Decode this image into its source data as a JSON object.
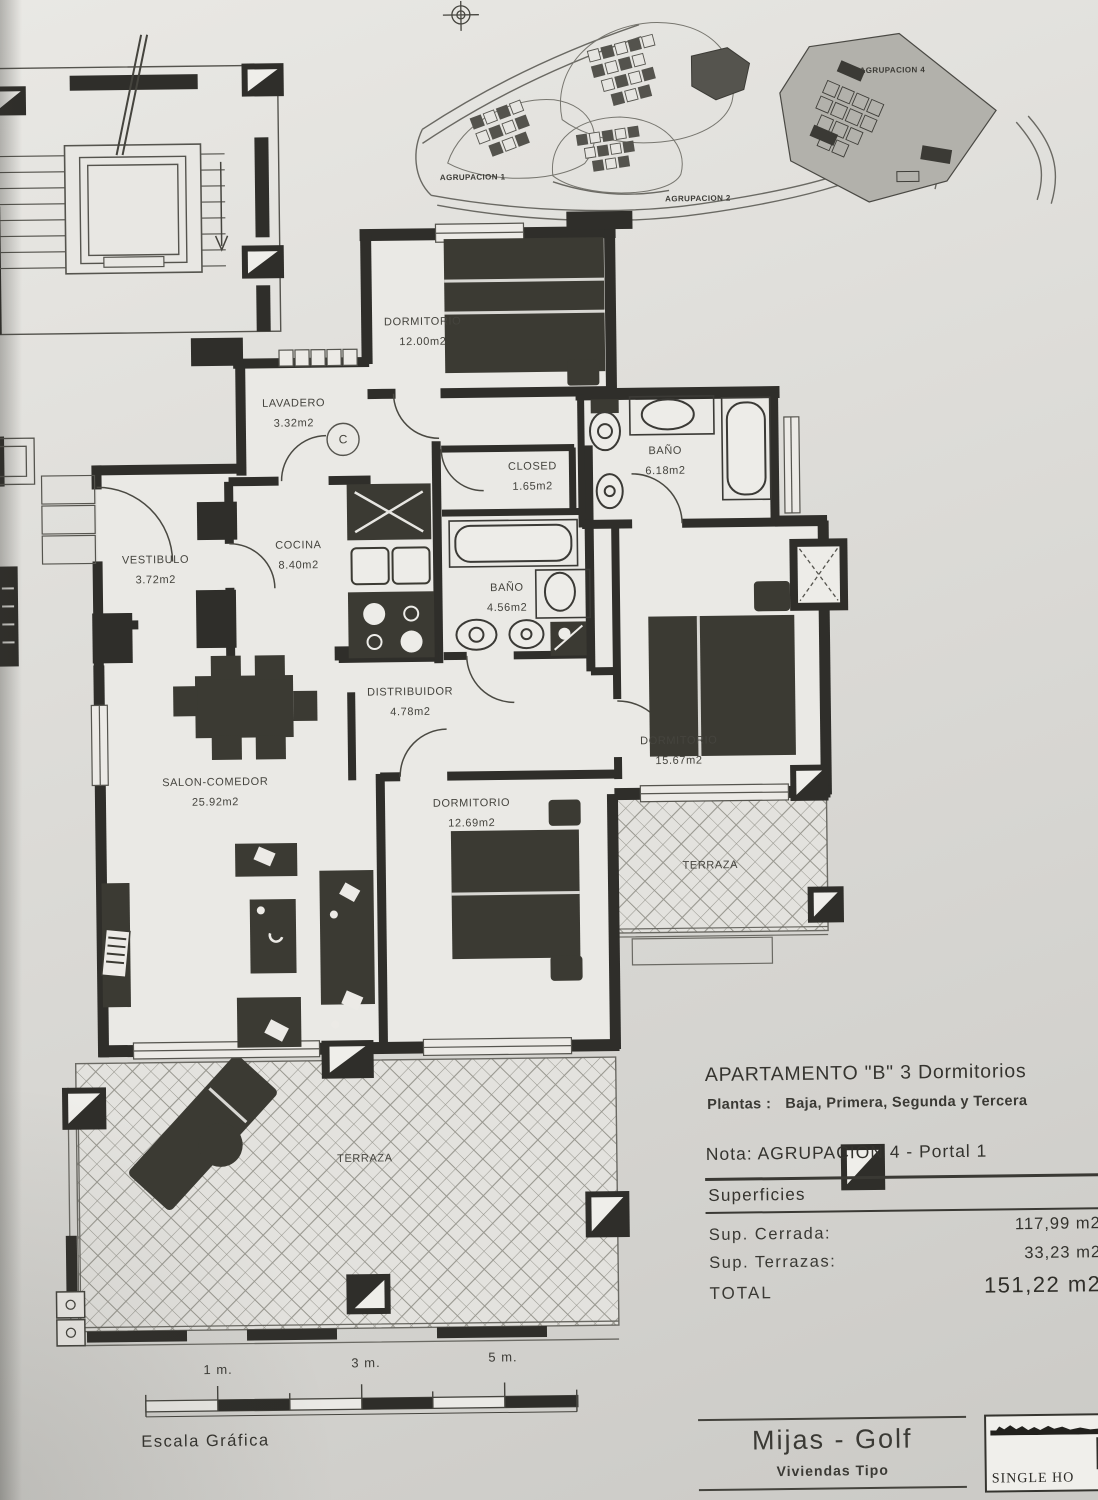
{
  "sheet": {
    "c_marker": "C"
  },
  "site_plan": {
    "labels": {
      "agrupacion1": "AGRUPACION 1",
      "agrupacion2": "AGRUPACION 2",
      "agrupacion4": "AGRUPACION 4"
    }
  },
  "plan": {
    "rooms": [
      {
        "name": "DORMITORIO",
        "area": "12.00m2"
      },
      {
        "name": "LAVADERO",
        "area": "3.32m2"
      },
      {
        "name": "CLOSED",
        "area": "1.65m2"
      },
      {
        "name": "BAÑO",
        "area": "6.18m2"
      },
      {
        "name": "VESTIBULO",
        "area": "3.72m2"
      },
      {
        "name": "COCINA",
        "area": "8.40m2"
      },
      {
        "name": "BAÑO",
        "area": "4.56m2"
      },
      {
        "name": "DISTRIBUIDOR",
        "area": "4.78m2"
      },
      {
        "name": "SALON-COMEDOR",
        "area": "25.92m2"
      },
      {
        "name": "DORMITORIO",
        "area": "12.69m2"
      },
      {
        "name": "DORMITORIO",
        "area": "15.67m2"
      },
      {
        "name": "TERRAZA"
      },
      {
        "name": "TERRAZA"
      }
    ]
  },
  "info": {
    "title": "APARTAMENTO \"B\" 3 Dormitorios",
    "plantas_label": "Plantas :",
    "plantas_value": "Baja, Primera, Segunda y Tercera",
    "nota": "Nota: AGRUPACION 4  - Portal 1",
    "superficies_heading": "Superficies",
    "sup_cerrada_label": "Sup. Cerrada:",
    "sup_cerrada_value": "117,99 m2",
    "sup_terrazas_label": "Sup. Terrazas:",
    "sup_terrazas_value": "33,23 m2",
    "total_label": "TOTAL",
    "total_value": "151,22 m2"
  },
  "scale_bar": {
    "tick1": "1 m.",
    "tick2": "3 m.",
    "tick3": "5 m.",
    "caption": "Escala Gráfica"
  },
  "title_block": {
    "project": "Mijas - Golf",
    "subtitle": "Viviendas Tipo",
    "logo_text": "SINGLE HO"
  }
}
